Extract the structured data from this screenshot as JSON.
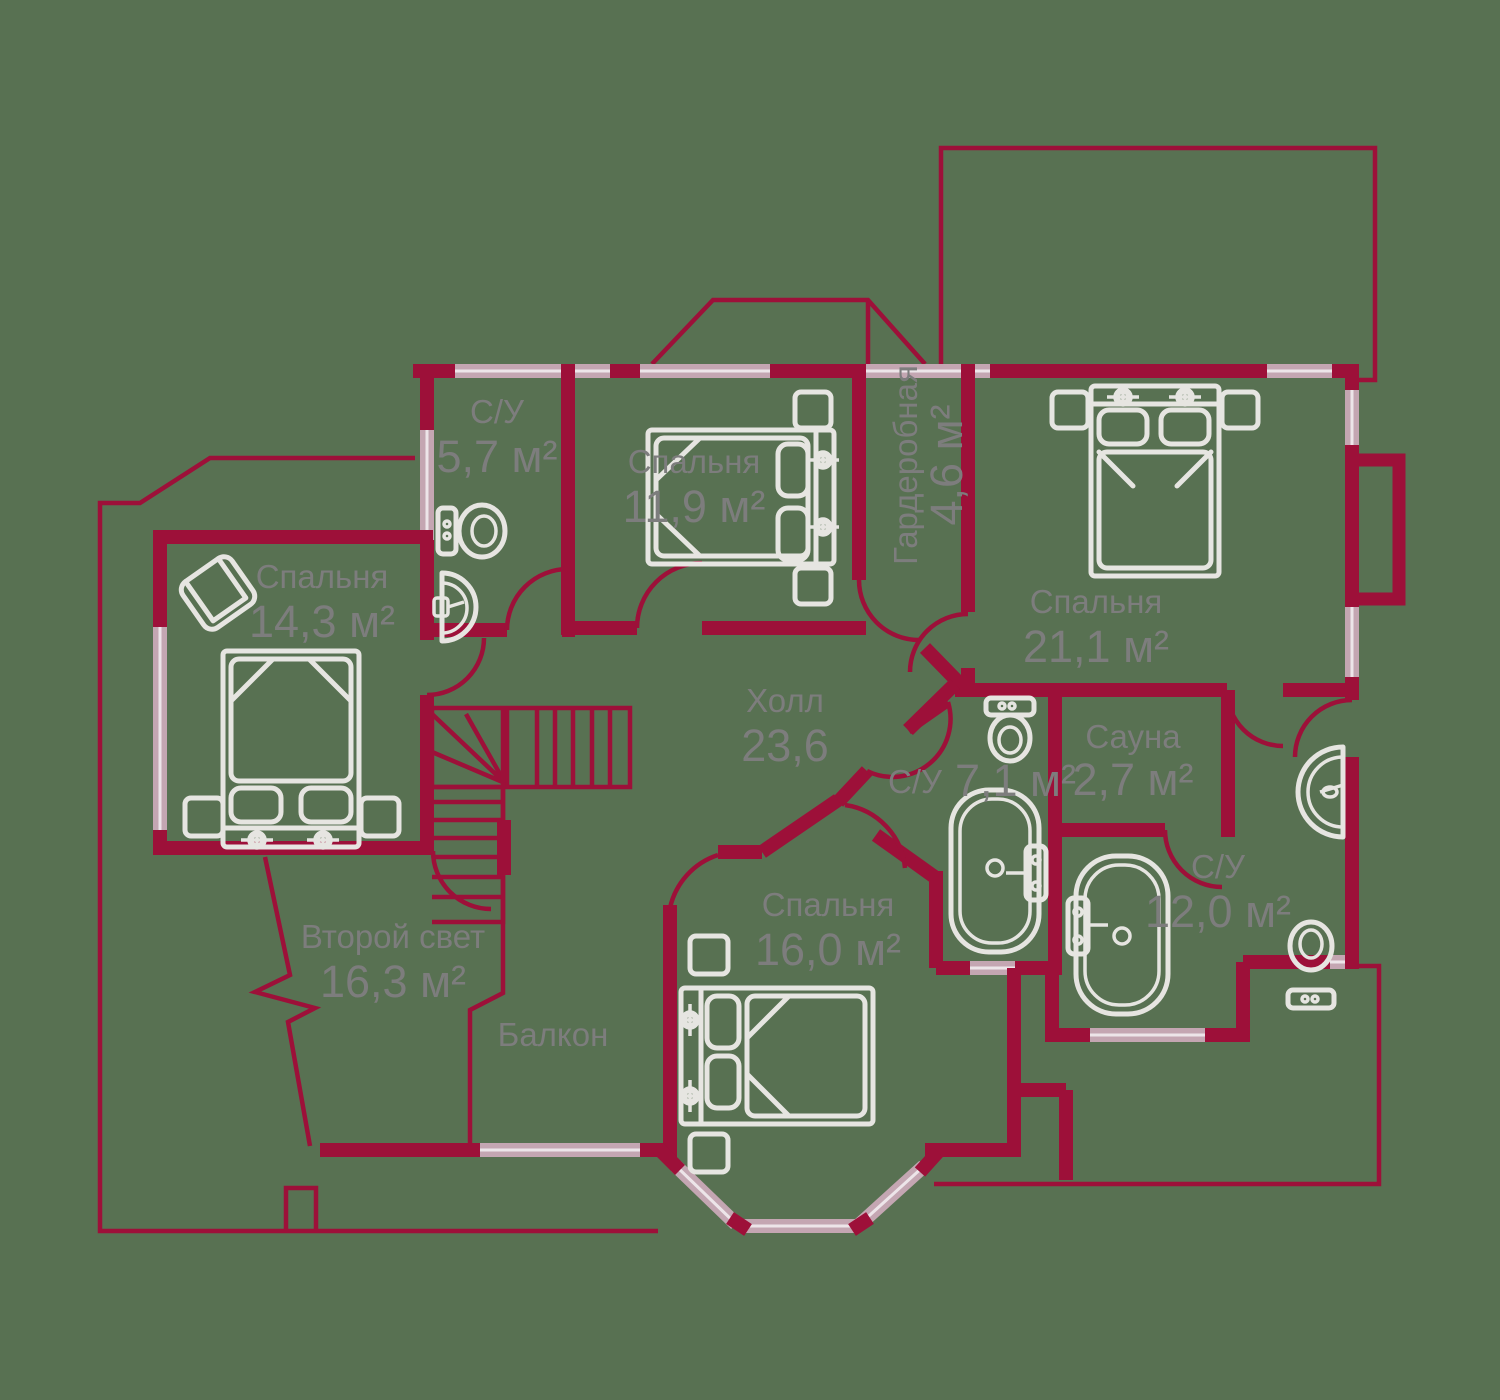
{
  "meta": {
    "kind": "floor-plan",
    "floor": "second",
    "language": "ru"
  },
  "palette": {
    "background": "#587152",
    "walls": "#9D1039",
    "windows": "#C4A6B2",
    "furniture": "#E6E5E1",
    "labels": "#7D7D7D"
  },
  "rooms": [
    {
      "id": "bathroom-top-left",
      "name": "С/У",
      "area": "5,7 м²"
    },
    {
      "id": "bedroom-top",
      "name": "Спальня",
      "area": "11,9 м²"
    },
    {
      "id": "wardrobe",
      "name": "Гардеробная",
      "area": "4,6 м²"
    },
    {
      "id": "bedroom-right",
      "name": "Спальня",
      "area": "21,1 м²"
    },
    {
      "id": "bedroom-left",
      "name": "Спальня",
      "area": "14,3 м²"
    },
    {
      "id": "hall",
      "name": "Холл",
      "area": "23,6"
    },
    {
      "id": "bathroom-middle",
      "name": "С/У",
      "area": "7,1 м²"
    },
    {
      "id": "sauna",
      "name": "Сауна",
      "area": "2,7 м²"
    },
    {
      "id": "bathroom-right",
      "name": "С/У",
      "area": "12,0 м²"
    },
    {
      "id": "bedroom-bottom",
      "name": "Спальня",
      "area": "16,0 м²"
    },
    {
      "id": "second-light",
      "name": "Второй свет",
      "area": "16,3 м²"
    },
    {
      "id": "balcony",
      "name": "Балкон",
      "area": ""
    }
  ]
}
